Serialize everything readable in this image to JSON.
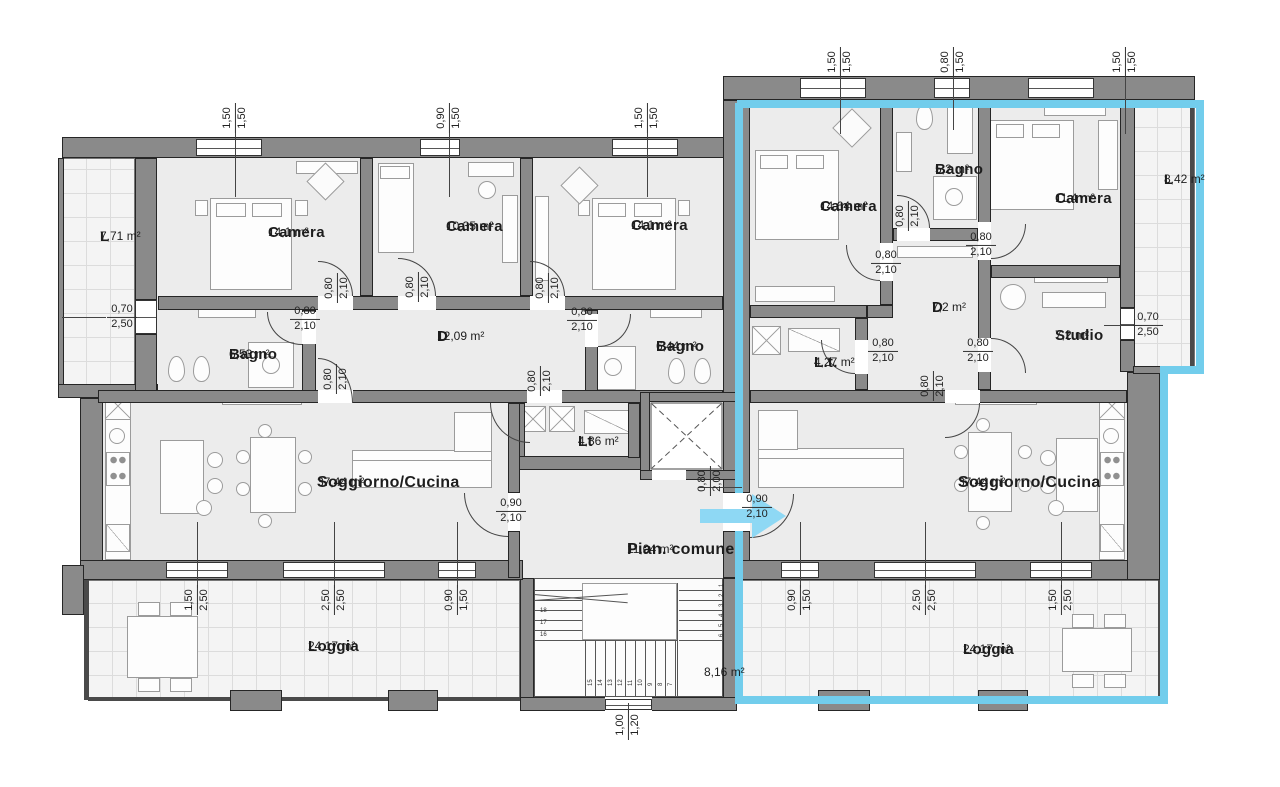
{
  "rooms": {
    "left": {
      "balcony": {
        "name": "L",
        "area": "7,71 m²"
      },
      "camera1": {
        "name": "Camera",
        "area": "14,1 m²"
      },
      "camera2": {
        "name": "Camera",
        "area": "10,35 m²"
      },
      "camera3": {
        "name": "Camera",
        "area": "14,1 m²"
      },
      "bagno1": {
        "name": "Bagno",
        "area": "6,53 m²"
      },
      "disimpegno": {
        "name": "D",
        "area": "12,09 m²"
      },
      "bagno2": {
        "name": "Bagno",
        "area": "6,44 m²"
      },
      "lavanderia": {
        "name": "Lt",
        "area": "4,86 m²"
      },
      "soggiorno": {
        "name": "Soggiorno/Cucina",
        "area": "37,44 m²"
      },
      "loggia": {
        "name": "Loggia",
        "area": "24,17 m²"
      }
    },
    "right": {
      "camera1": {
        "name": "Camera",
        "area": "14,64 m²"
      },
      "bagno": {
        "name": "Bagno",
        "area": "5,2 m²"
      },
      "camera2": {
        "name": "Camera",
        "area": "11,4 m²"
      },
      "balcony": {
        "name": "L",
        "area": "8,42 m²"
      },
      "lavanderia": {
        "name": "L.t.",
        "area": "4,27 m²"
      },
      "disimpegno": {
        "name": "D",
        "area": "7,2 m²"
      },
      "studio": {
        "name": "Studio",
        "area": "7,2 m²"
      },
      "soggiorno": {
        "name": "Soggiorno/Cucina",
        "area": "37,44 m²"
      },
      "loggia": {
        "name": "Loggia",
        "area": "24,17 m²"
      }
    },
    "common": {
      "hall": {
        "name": "Pian. comune",
        "area": "11,04 m²"
      },
      "stairs_area": "8,16 m²"
    }
  },
  "dims": {
    "top_l1": {
      "top": "1,50",
      "bottom": "1,50"
    },
    "top_l2": {
      "top": "0,90",
      "bottom": "1,50"
    },
    "top_l3": {
      "top": "1,50",
      "bottom": "1,50"
    },
    "top_r1": {
      "top": "1,50",
      "bottom": "1,50"
    },
    "top_r2": {
      "top": "0,80",
      "bottom": "1,50"
    },
    "top_r3": {
      "top": "1,50",
      "bottom": "1,50"
    },
    "left_edge": {
      "top": "0,70",
      "bottom": "2,50"
    },
    "right_edge": {
      "top": "0,70",
      "bottom": "2,50"
    },
    "door1": {
      "top": "0,80",
      "bottom": "2,10"
    },
    "door2": {
      "top": "0,80",
      "bottom": "2,10"
    },
    "door3": {
      "top": "0,80",
      "bottom": "2,10"
    },
    "door4": {
      "top": "0,80",
      "bottom": "2,10"
    },
    "door5": {
      "top": "0,80",
      "bottom": "2,10"
    },
    "door6": {
      "top": "0,80",
      "bottom": "2,10"
    },
    "door7": {
      "top": "0,80",
      "bottom": "2,10"
    },
    "door8": {
      "top": "0,80",
      "bottom": "2,10"
    },
    "door9": {
      "top": "0,80",
      "bottom": "2,10"
    },
    "door10": {
      "top": "0,80",
      "bottom": "2,10"
    },
    "door11": {
      "top": "0,80",
      "bottom": "2,10"
    },
    "door12": {
      "top": "0,80",
      "bottom": "2,10"
    },
    "door13": {
      "top": "0,80",
      "bottom": "2,10"
    },
    "hall_door_left": {
      "top": "0,90",
      "bottom": "2,10"
    },
    "hall_door_right": {
      "top": "0,90",
      "bottom": "2,10"
    },
    "elevator_door": {
      "top": "0,80",
      "bottom": "2,00"
    },
    "bottom_l1": {
      "top": "1,50",
      "bottom": "2,50"
    },
    "bottom_l2": {
      "top": "2,50",
      "bottom": "2,50"
    },
    "bottom_l3": {
      "top": "0,90",
      "bottom": "1,50"
    },
    "bottom_r1": {
      "top": "0,90",
      "bottom": "1,50"
    },
    "bottom_r2": {
      "top": "2,50",
      "bottom": "2,50"
    },
    "bottom_r3": {
      "top": "1,50",
      "bottom": "2,50"
    },
    "stair_exit": {
      "top": "1,00",
      "bottom": "1,20"
    }
  },
  "stairs": {
    "area": "8,16 m²",
    "left_steps": [
      "18",
      "17",
      "16"
    ],
    "bottom_steps": [
      "15",
      "14",
      "13",
      "12",
      "11",
      "10",
      "9",
      "8",
      "7"
    ],
    "right_steps": [
      "1",
      "2",
      "3",
      "4",
      "5",
      "6"
    ]
  },
  "colors": {
    "wall": "#8a8a8a",
    "highlight": "#72cdec",
    "arrow": "#8ed8f4",
    "floor": "#ececec",
    "line": "#262626"
  }
}
